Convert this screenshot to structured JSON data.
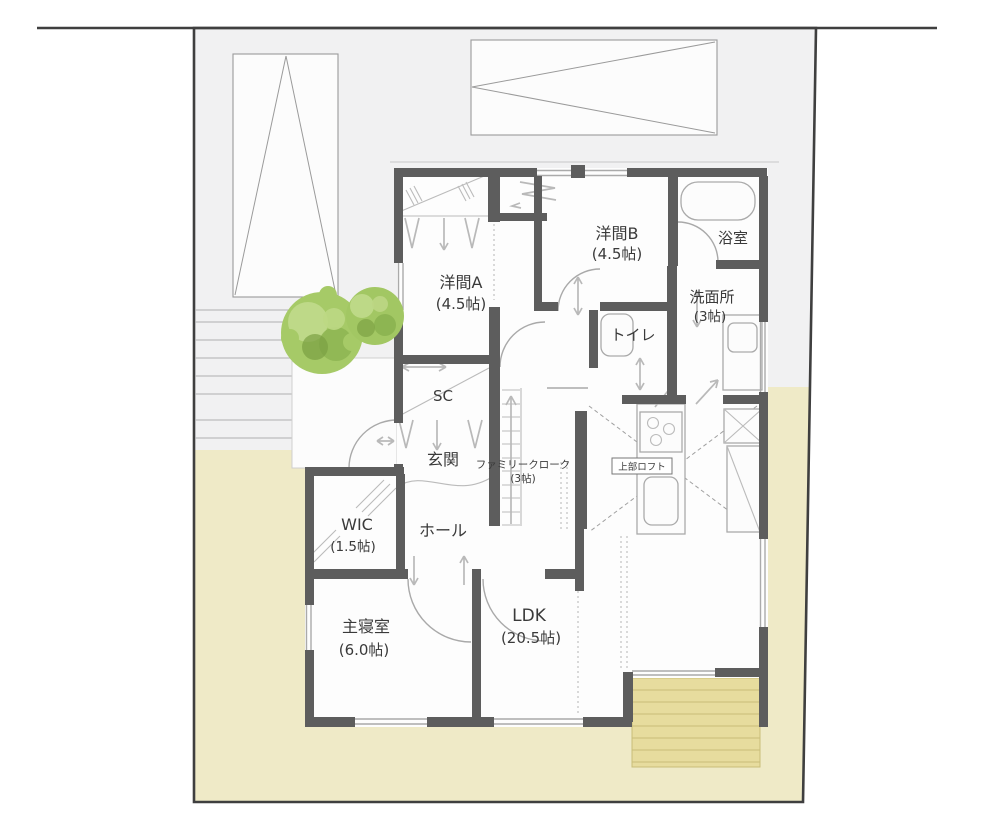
{
  "title": "floor-plan",
  "rooms": [
    {
      "id": "yoma-a",
      "label": "洋間A",
      "size": "(4.5帖)"
    },
    {
      "id": "yoma-b",
      "label": "洋間B",
      "size": "(4.5帖)"
    },
    {
      "id": "bathroom",
      "label": "浴室",
      "size": ""
    },
    {
      "id": "washroom",
      "label": "洗面所",
      "size": "(3帖)"
    },
    {
      "id": "toilet",
      "label": "トイレ",
      "size": ""
    },
    {
      "id": "shoes-closet",
      "label": "SC",
      "size": ""
    },
    {
      "id": "entrance",
      "label": "玄関",
      "size": ""
    },
    {
      "id": "hall",
      "label": "ホール",
      "size": ""
    },
    {
      "id": "wic",
      "label": "WIC",
      "size": "(1.5帖)"
    },
    {
      "id": "family-closet",
      "label": "ファミリークローク",
      "size": "(3帖)"
    },
    {
      "id": "upper-loft",
      "label": "上部ロフト",
      "size": ""
    },
    {
      "id": "master-bedroom",
      "label": "主寝室",
      "size": "(6.0帖)"
    },
    {
      "id": "ldk",
      "label": "LDK",
      "size": "(20.5帖)"
    }
  ],
  "colors": {
    "site_ground": "#f1f1f2",
    "yard": "#efeac7",
    "deck": "#e7dc9e",
    "wall": "#5d5d5d",
    "boundary": "#3f3f3f",
    "tree_green": "#a6ca67"
  }
}
